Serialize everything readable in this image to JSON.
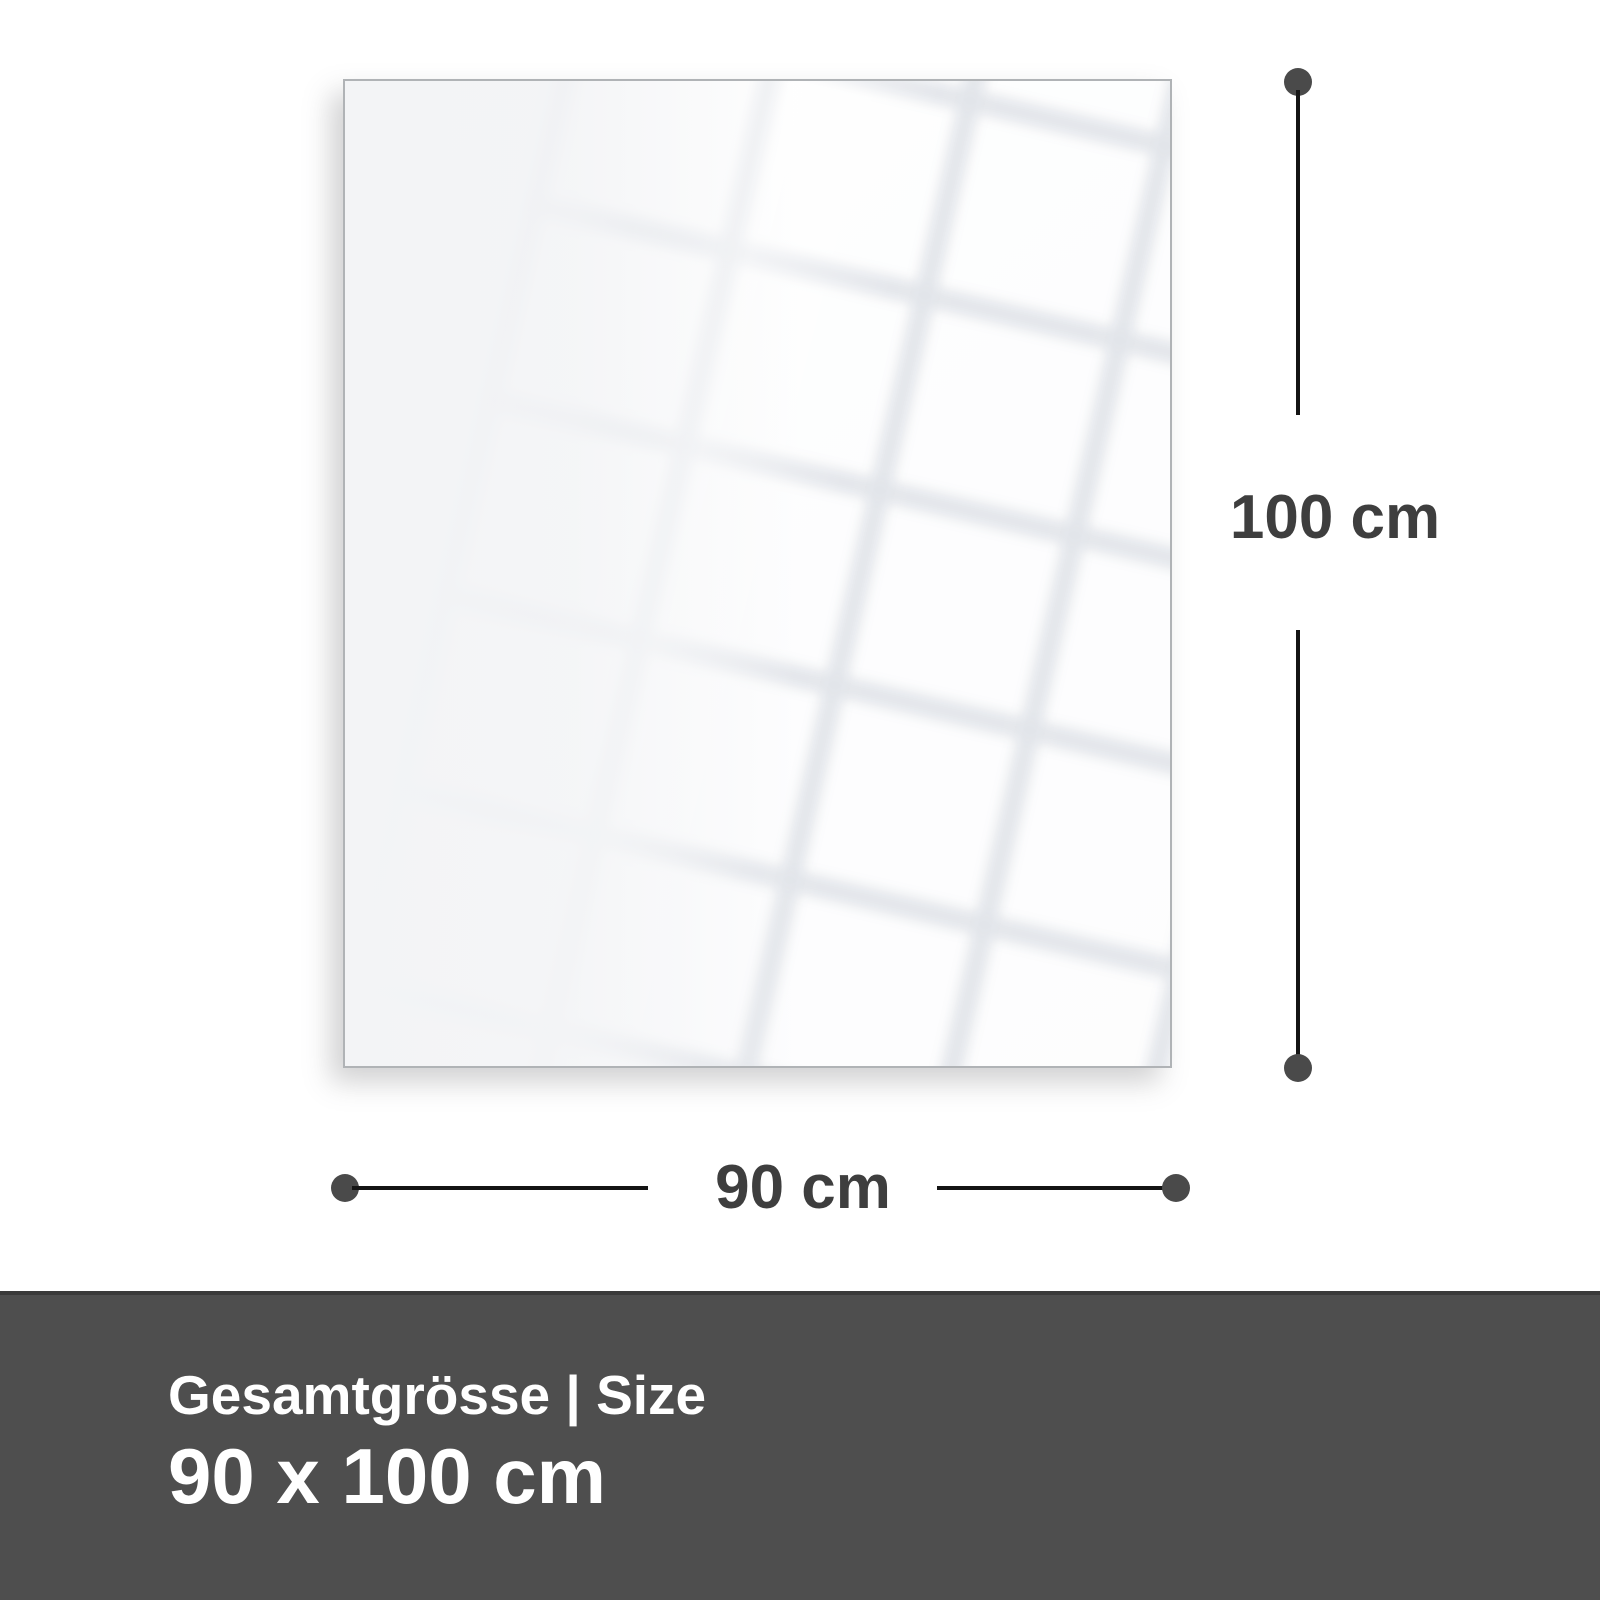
{
  "diagram": {
    "width_label": "90 cm",
    "height_label": "100 cm"
  },
  "footer": {
    "title": "Gesamtgrösse | Size",
    "size_value": "90 x 100 cm"
  },
  "colors": {
    "line": "#141414",
    "endpoint": "#4a4a4a",
    "dimension_text": "#3e3e3e",
    "footer_bg": "#4e4e4e",
    "footer_border": "#3a3a3a",
    "footer_text": "#ffffff",
    "panel_fill": "#f3f4f6",
    "panel_border": "#b0b3b6"
  }
}
